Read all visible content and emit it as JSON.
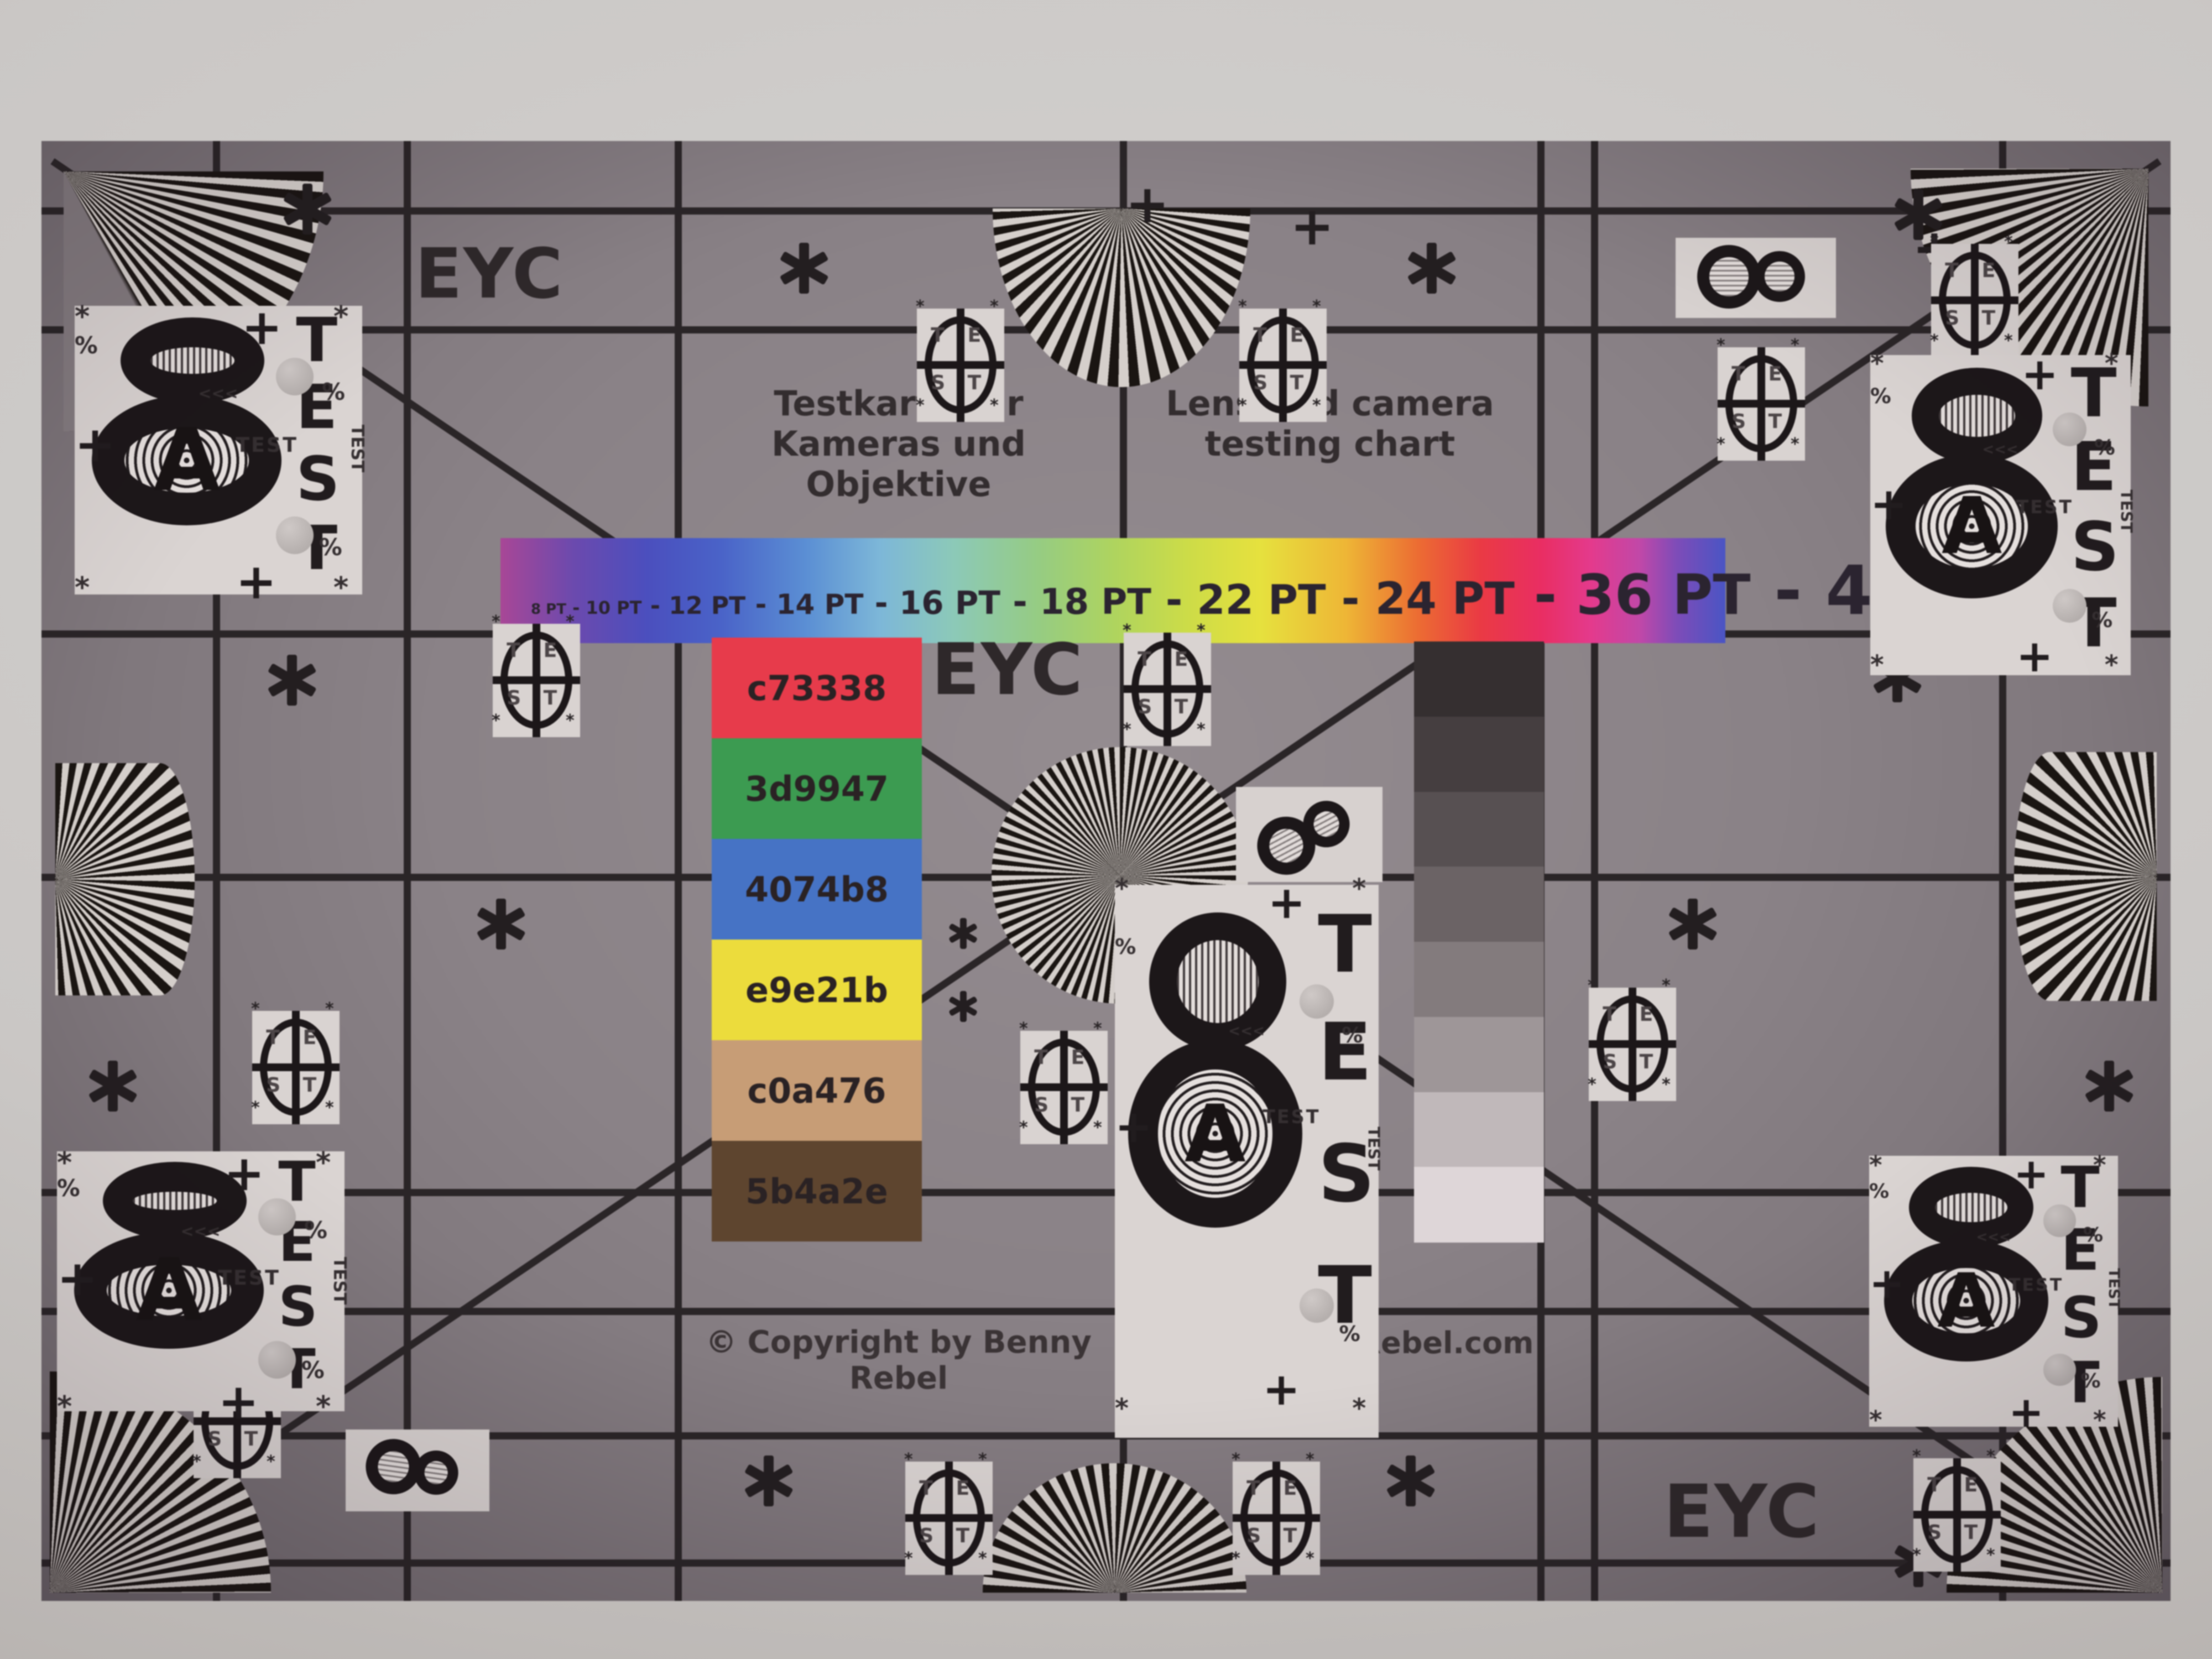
{
  "eyc_label": "EYC",
  "title_de": {
    "line1": "Testkarte für",
    "line2": "Kameras und Objektive"
  },
  "title_en": {
    "line1": "Lens and camera",
    "line2": "testing chart"
  },
  "pt_scale": {
    "labels": [
      "8 PT",
      "10 PT",
      "12 PT",
      "14 PT",
      "16 PT",
      "18 PT",
      "22 PT",
      "24 PT",
      "36 PT",
      "48 PT"
    ],
    "separator": "-"
  },
  "color_patches": [
    {
      "label": "c73338",
      "swatch": "#e73b4b"
    },
    {
      "label": "3d9947",
      "swatch": "#3c9b51"
    },
    {
      "label": "4074b8",
      "swatch": "#4673c5"
    },
    {
      "label": "e9e21b",
      "swatch": "#ecdc3c"
    },
    {
      "label": "c0a476",
      "swatch": "#c79d76"
    },
    {
      "label": "5b4a2e",
      "swatch": "#5e452f"
    }
  ],
  "grayscale_steps": [
    "#352f30",
    "#453e40",
    "#575052",
    "#6b6365",
    "#837b7d",
    "#9e9698",
    "#c0b8ba",
    "#ded6d8"
  ],
  "footer": {
    "copyright": "© Copyright by Benny Rebel",
    "website": "www.Benny-Rebel.com"
  },
  "test_markings": {
    "figure_eight": "8",
    "letter_a": "A",
    "test_letters": [
      "T",
      "E",
      "S",
      "T"
    ],
    "test_word": "TEST",
    "asterisk": "*",
    "plus": "+",
    "percent": "%",
    "chevrons": "<<<"
  },
  "colors": {
    "chart_background": "#8a8287",
    "grid_line": "#2a2527",
    "card_white": "#d9d3d1",
    "ink_black": "#1c1719",
    "wall": "#cac7c5"
  }
}
